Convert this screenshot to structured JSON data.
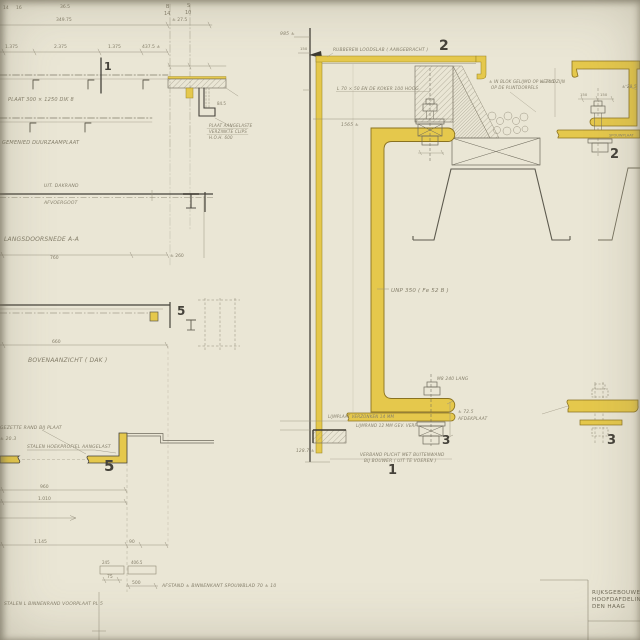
{
  "canvas": {
    "width": 640,
    "height": 640,
    "kind": "scanned construction detail drawing"
  },
  "colors": {
    "paper": "#eae6d5",
    "ink": "#3f3c32",
    "pencil": "#8f8a77",
    "yellow": "#e5c84c"
  },
  "labels": {
    "d1": "1",
    "d2": "2",
    "d2r": "2",
    "d3": "3",
    "d3r": "3",
    "d5_plan": "5",
    "d5": "5",
    "cut1": "1"
  },
  "title_block": {
    "line1": "RIJKSGEBOUWENDIENST",
    "line2": "HOOFDAFDELING ONDERH.",
    "line3": "DEN  HAAG"
  },
  "ann": {
    "plate": "PLAAT 300 × 1250  DIK 8",
    "duurzaam": "GEMENIED  DUURZAAMPLAAT",
    "clips1": "PLAAT AANGELASTE",
    "clips2": "VERZINKTE  CLIPS",
    "clips3": "H.O.H.  600",
    "mark365": "36.5",
    "frac_a": "14",
    "frac_b": "16",
    "grid1_top": "B",
    "grid1_bot": "14",
    "grid2_top": "S",
    "grid2_bot": "10",
    "v845": "84.5",
    "dakrand": "UIT. DAKRAND",
    "goot": "AFVOERGOOT",
    "doorsnede": "LANGSDOORSNEDE  A-A",
    "bovenaanzicht": "BOVENAANZICHT  ( DAK )",
    "rand": "GEZETTE RAND BIJ PLAAT",
    "pm203": "± 20.3",
    "hoek": "STALEN HOEKPROFIEL  AANGELAST",
    "afstand": "AFSTAND ± BINNENKANT SPOUWBLAD  70 ± 10",
    "binnenrand": "STALEN L BINNENRAND VOORPLAAT  PL 5",
    "rubber": "RUBBEREN LOODSLAB ( AANGEBRACHT )",
    "koker": "L 70 × 50  EN DE KOKER  100 HOOG",
    "iso1": "± IN BLOK GELIJMD OP HET KOZIJN",
    "iso2": "OP DE PLINTDORPELS",
    "unp": "UNP 350 ( Fe 52 B )",
    "m8": "M8  240 LANG",
    "pm725": "± 72.5",
    "afdek": "AFDEKPLAAT",
    "lijm1": "LIJMPLAAT VERZONKEN  14 MM",
    "lijm2": "LIJMRAND 12 MM  GEV. VERF",
    "verband1": "VERBAND PLICHT MET BUITENWAND",
    "verband2": "BIJ BOUWER ( UIT TE VOEREN )",
    "d985": "985 ±",
    "d1565": "1565 ±",
    "d1287": "128.7 ±",
    "pm295": "± 29.5",
    "pm345": "± 34.5",
    "spouwplaat": "SPOUWPLAAT",
    "d150a": "150",
    "d150b": "150"
  },
  "dims": {
    "d34975": "349.75",
    "d275": "± 27.5",
    "d1375a": "1.375",
    "d2375": "2.375",
    "d1375b": "1.375",
    "d4375": "437.5 ±",
    "d760": "760",
    "d260": "± 260",
    "d660": "660",
    "d960": "960",
    "d1010": "1.010",
    "d1145": "1.145",
    "d90": "90",
    "d245": "245",
    "d4065": "406.5",
    "d75": "75",
    "d500": "500"
  }
}
